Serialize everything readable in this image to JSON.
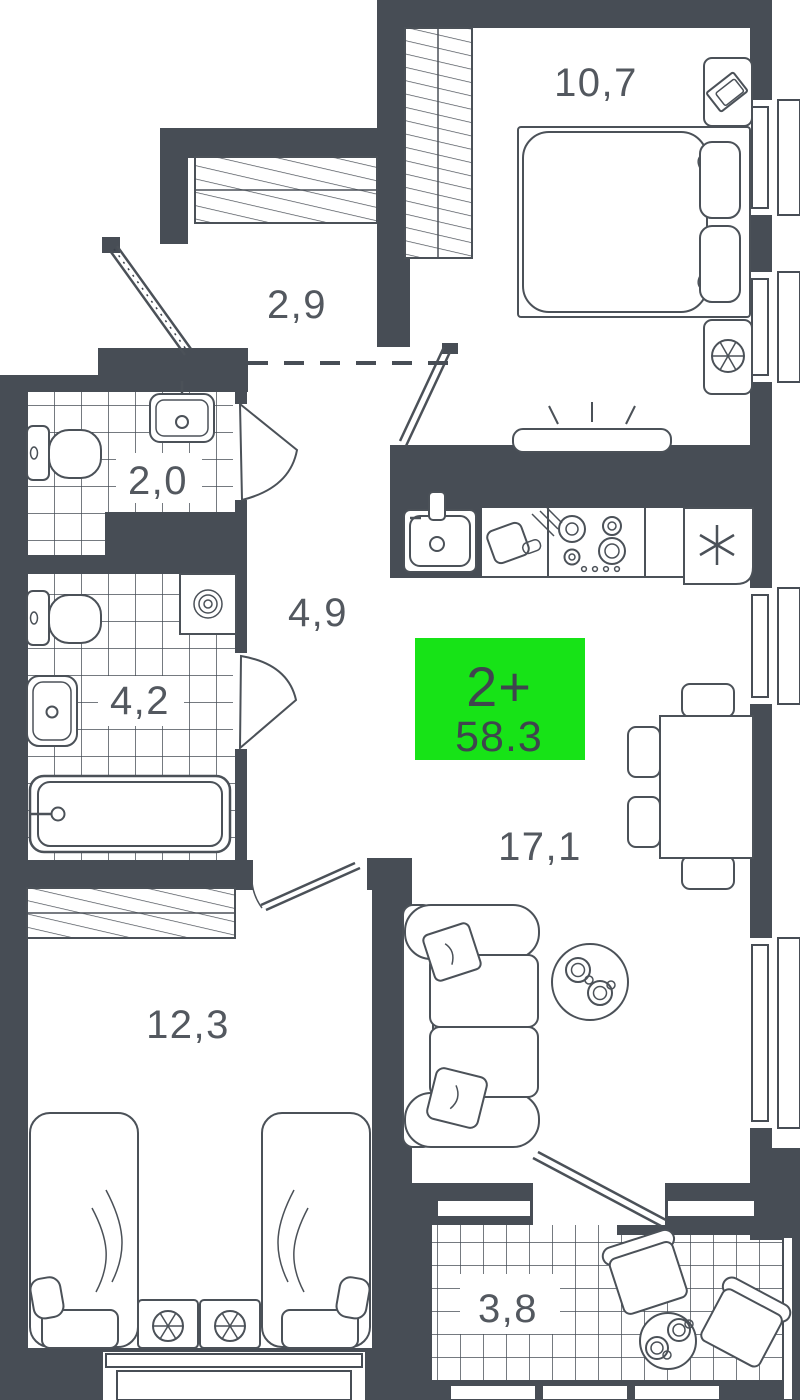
{
  "badge": {
    "type": "2+",
    "area": "58.3",
    "color": "#17e317"
  },
  "rooms": {
    "bedroom1": {
      "name": "bedroom",
      "label": "10,7"
    },
    "closet": {
      "name": "closet",
      "label": "2,9"
    },
    "wc": {
      "name": "wc",
      "label": "2,0"
    },
    "hallway": {
      "name": "hallway",
      "label": "4,9"
    },
    "bathroom": {
      "name": "bathroom",
      "label": "4,2"
    },
    "bedroom2": {
      "name": "bedroom",
      "label": "12,3"
    },
    "living_kitchen": {
      "name": "living-kitchen",
      "label": "17,1"
    },
    "balcony": {
      "name": "balcony",
      "label": "3,8"
    }
  },
  "colors": {
    "wall": "#474d55",
    "furniture_line": "#4b5158",
    "label_text": "#53585f",
    "badge_green": "#17e317"
  }
}
